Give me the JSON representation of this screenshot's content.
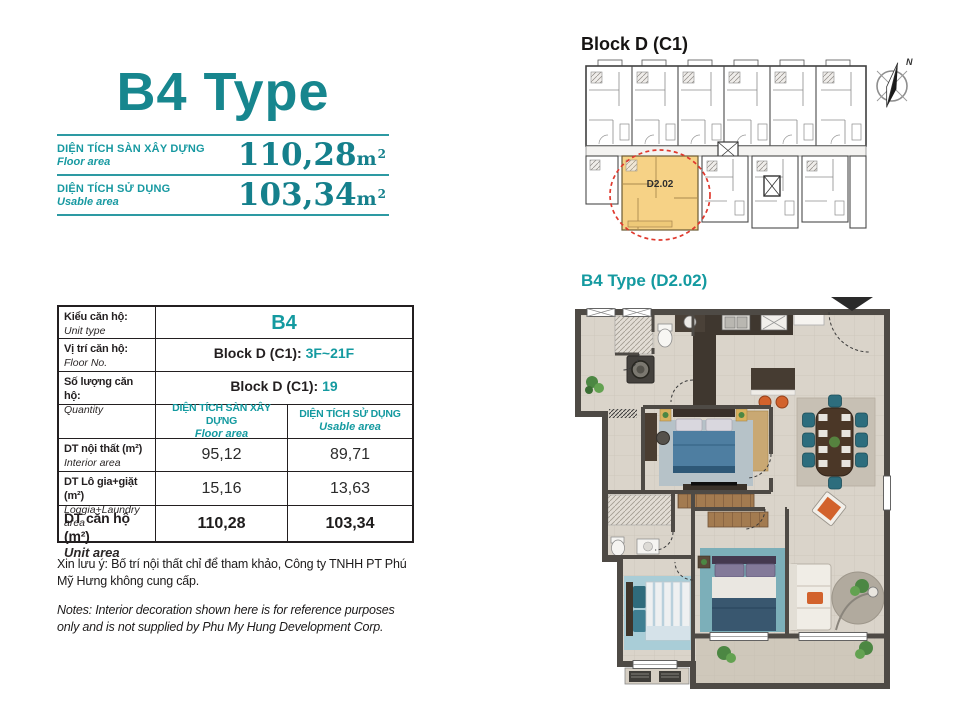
{
  "colors": {
    "teal_title": "#17868e",
    "teal_table": "#149aa0",
    "teal_value": "#15808c",
    "divider_teal": "#2d9aa3",
    "highlight_yellow": "#f6d286",
    "highlight_red": "#e0392e",
    "wall_gray": "#4e4a45"
  },
  "header": {
    "title": "B4 Type",
    "rows": [
      {
        "label_vi": "DIỆN TÍCH SÀN XÂY DỰNG",
        "label_en": "Floor area",
        "value": "110,28",
        "unit_base": "m",
        "unit_exp": "2"
      },
      {
        "label_vi": "DIỆN TÍCH SỬ DỤNG",
        "label_en": "Usable area",
        "value": "103,34",
        "unit_base": "m",
        "unit_exp": "2"
      }
    ]
  },
  "spec_table": {
    "info_rows": [
      {
        "label_vi": "Kiểu căn hộ:",
        "label_en": "Unit type",
        "value_prefix": "",
        "value_teal": "B4"
      },
      {
        "label_vi": "Vị trí căn hộ:",
        "label_en": "Floor No.",
        "value_prefix": "Block D (C1): ",
        "value_teal": "3F~21F"
      },
      {
        "label_vi": "Số lượng căn hộ:",
        "label_en": "Quantity",
        "value_prefix": "Block D (C1): ",
        "value_teal": "19"
      }
    ],
    "col_headers": [
      {
        "vi": "DIỆN TÍCH SÀN XÂY DỰNG",
        "en": "Floor area"
      },
      {
        "vi": "DIỆN TÍCH SỬ DỤNG",
        "en": "Usable area"
      }
    ],
    "area_rows": [
      {
        "label_vi": "DT nội thất  (m²)",
        "label_en": "Interior area",
        "floor": "95,12",
        "usable": "89,71"
      },
      {
        "label_vi": "DT Lô gia+giặt  (m²)",
        "label_en": "Loggia+Laundry area",
        "floor": "15,16",
        "usable": "13,63"
      },
      {
        "label_vi": "DT căn hộ (m²)",
        "label_en": "Unit area",
        "floor": "110,28",
        "usable": "103,34"
      }
    ]
  },
  "notes": {
    "vi": "Xin lưu ý: Bố trí nội thất chỉ để tham khảo, Công ty TNHH PT Phú Mỹ Hưng không cung cấp.",
    "en": "Notes: Interior decoration shown here is for reference purposes only and is not supplied by Phu My Hung Development Corp."
  },
  "block_plan": {
    "title": "Block D (C1)",
    "unit_label": "D2.02",
    "compass_label": "N"
  },
  "floor_plan": {
    "title": "B4 Type (D2.02)"
  }
}
